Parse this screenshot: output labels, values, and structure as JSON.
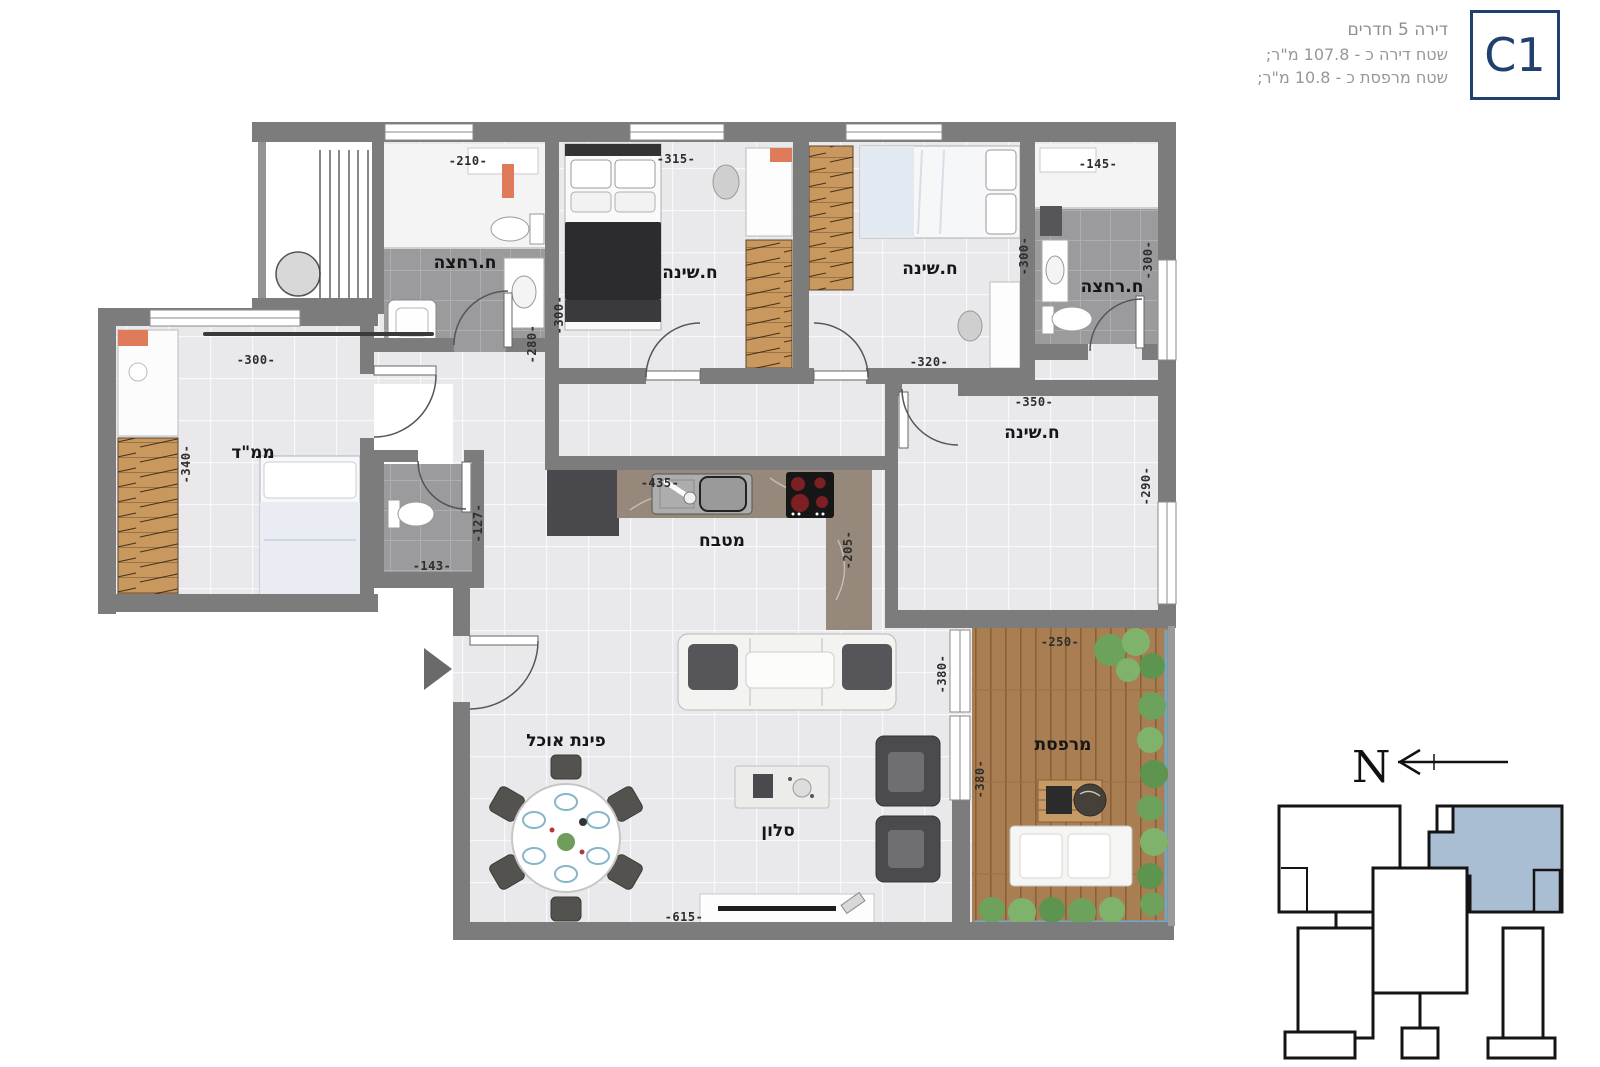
{
  "header": {
    "unit_label": "C1",
    "line1": "דירה 5 חדרים",
    "line2": "שטח דירה כ - 107.8 מ\"ר;",
    "line3": "שטח מרפסת כ - 10.8 מ\"ר;"
  },
  "rooms": [
    {
      "id": "bathroom-1",
      "label": "ח.רחצה"
    },
    {
      "id": "bedroom-1",
      "label": "ח.שינה"
    },
    {
      "id": "bedroom-2",
      "label": "ח.שינה"
    },
    {
      "id": "bathroom-2",
      "label": "ח.רחצה"
    },
    {
      "id": "mamad-safe-room",
      "label": "ממ\"ד"
    },
    {
      "id": "kitchen",
      "label": "מטבח"
    },
    {
      "id": "master-bedroom",
      "label": "ח.שינה"
    },
    {
      "id": "dining-corner",
      "label": "פינת אוכל"
    },
    {
      "id": "living-room",
      "label": "סלון"
    },
    {
      "id": "balcony",
      "label": "מרפסת"
    }
  ],
  "dims": [
    {
      "text": "-210-"
    },
    {
      "text": "-315-"
    },
    {
      "text": "-145-"
    },
    {
      "text": "-300-"
    },
    {
      "text": "-280-"
    },
    {
      "text": "-320-"
    },
    {
      "text": "-300-"
    },
    {
      "text": "-300-"
    },
    {
      "text": "-300-"
    },
    {
      "text": "-340-"
    },
    {
      "text": "-143-"
    },
    {
      "text": "-127-"
    },
    {
      "text": "-435-"
    },
    {
      "text": "-205-"
    },
    {
      "text": "-350-"
    },
    {
      "text": "-290-"
    },
    {
      "text": "-250-"
    },
    {
      "text": "-380-"
    },
    {
      "text": "-380-"
    },
    {
      "text": "-615-"
    }
  ],
  "compass": {
    "north_label": "N"
  },
  "colors": {
    "wall": "#7c7c7c",
    "accent_navy": "#20406e",
    "keyplan_unit_fill": "#a9bed3",
    "deck_wood": "#a97e52",
    "wardrobe_wood": "#c9985f",
    "plant_green": "#6da25c",
    "railing_blue": "#6fa8ca"
  }
}
